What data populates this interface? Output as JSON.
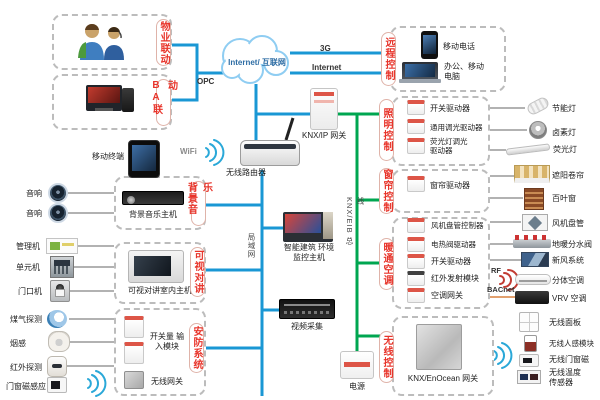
{
  "colors": {
    "line_blue": "#1a97d4",
    "line_green": "#00a650",
    "line_orange": "#e2a06e",
    "label_red": "#e8342a",
    "box_border": "#bcbcbc"
  },
  "cloud_label": "Internet/ 互联网",
  "link_labels": {
    "g3": "3G",
    "internet": "Internet",
    "opc": "OPC",
    "wifi": "WiFi",
    "lan": "局域网",
    "knx_bus": "KNX/EIB 总线",
    "rf": "RF",
    "bacnet": "BACnet"
  },
  "left": {
    "property_box": "物业联动",
    "ba_box": "BA联动",
    "mobile_terminal": "移动终端",
    "speaker1": "音响",
    "speaker2": "音响",
    "mgmt": "管理机",
    "unit": "单元机",
    "door_station": "门口机",
    "gas": "煤气探测",
    "smoke": "烟感",
    "pir": "红外探测",
    "door_magnet": "门窗磁感应"
  },
  "groups": {
    "bgm": {
      "label": "背景音乐",
      "host": "背景音乐主机"
    },
    "intercom": {
      "label": "可视对讲",
      "host": "可视对讲室内主机"
    },
    "security": {
      "label": "安防系统",
      "input_module": "开关量 输入模块",
      "wireless_gw": "无线网关"
    }
  },
  "center": {
    "router": "无线路由器",
    "knx_ip_gw": "KNX/IP 网关",
    "monitor_host": "智能建筑 环境监控主机",
    "video_capture": "视频采集",
    "power": "电源"
  },
  "remote": {
    "label": "远程控制",
    "phone": "移动电话",
    "laptop": "办公、移动 电脑"
  },
  "lighting": {
    "label": "照明控制",
    "items": [
      "开关驱动器",
      "通用调光驱动器",
      "荧光灯调光 驱动器"
    ],
    "devices": [
      "节能灯",
      "卤素灯",
      "荧光灯"
    ]
  },
  "curtain": {
    "label": "窗帘控制",
    "items": [
      "窗帘驱动器"
    ],
    "devices": [
      "遮阳卷帘",
      "百叶窗"
    ]
  },
  "hvac": {
    "label": "暖通空调",
    "items": [
      "风机盘管控制器",
      "电热阀驱动器",
      "开关驱动器",
      "红外发射模块",
      "空调网关"
    ],
    "devices": [
      "风机盘管",
      "地暖分水阀",
      "新风系统",
      "分体空调",
      "VRV 空调"
    ]
  },
  "wireless": {
    "label": "无线控制",
    "gateway": "KNX/EnOcean 网关",
    "devices": [
      "无线面板",
      "无线人感模块",
      "无线门窗磁",
      "无线温度 传感器"
    ]
  }
}
